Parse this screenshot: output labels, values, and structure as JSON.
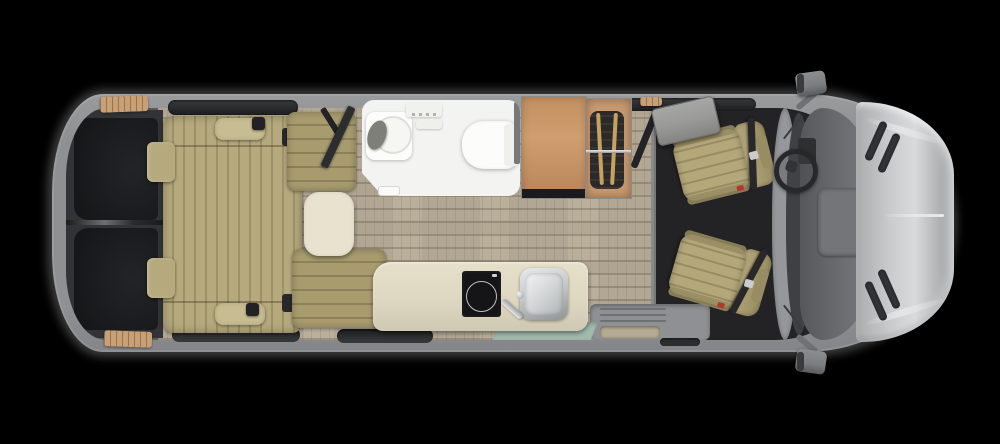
{
  "canvas": {
    "width": 1000,
    "height": 444
  },
  "scene": {
    "type": "rv-camper-van-floorplan-top-view",
    "text_visible": false,
    "parts": [
      "van-body",
      "rear-doors",
      "rear-sofa-bed",
      "sofa-pillow",
      "door-armrest-cushion",
      "dinette-bench-front",
      "dinette-bench-rear",
      "dinette-table",
      "lounge-tv-on-arm",
      "wet-bath",
      "bath-sink",
      "shower-control",
      "toilet",
      "wardrobe-cabinet",
      "hanging-closet",
      "cab-tv-on-arm",
      "galley-counter",
      "induction-cooktop",
      "kitchen-sink",
      "faucet",
      "entry-mat",
      "entry-step-well",
      "driver-swivel-seat",
      "passenger-swivel-seat",
      "dashboard",
      "steering-wheel",
      "windshield",
      "hood",
      "hood-vents",
      "side-mirror-left",
      "side-mirror-right",
      "side-windows",
      "wood-floor-grate",
      "plaid-floor-rug",
      "cab-floor"
    ]
  },
  "palette": {
    "background": "#000000",
    "body-gray": "#8f9092",
    "window-dark": "#1c1d1f",
    "floor-beige": "#c3b7a1",
    "plaid-base": "#b2a794",
    "rear-zone": "#323336",
    "rear-panel": "#161719",
    "wood-grate": "#c7a076",
    "sofa-tan": "#b5a97d",
    "pillow-tan": "#c8bc92",
    "bench-olive": "#a89c6f",
    "table-cream": "#e8e2cf",
    "bath-white": "#f3f3f1",
    "fixture-white": "#fcfcfa",
    "wood-cabinet": "#cf9e6f",
    "closet-wood": "#c99a70",
    "clothes-dark": "#2b2a28",
    "rod-silver": "#c6c8ca",
    "hanger-tan": "#c6a160",
    "tv-gray": "#9a9a99",
    "arm-dark": "#232326",
    "counter-cream": "#ded7c2",
    "cooktop-black": "#151517",
    "sink-steel": "#c7cacc",
    "mat-teal": "#a2b9ae",
    "step-gray": "#8f9093",
    "step-inset": "#b5aa93",
    "cab-floor": "#232325",
    "seat-tan": "#b4a87b",
    "seat-shadow": "#988c62",
    "belt-dark": "#28282b",
    "dash-gray": "#66686b",
    "glass-dark": "#3e4043",
    "frame-gray": "#95979a",
    "hood-silver": "#c9cbcd",
    "hood-bright": "#e9eaeb",
    "vent-dark": "#323437",
    "mirror-gray": "#7b7d80"
  }
}
